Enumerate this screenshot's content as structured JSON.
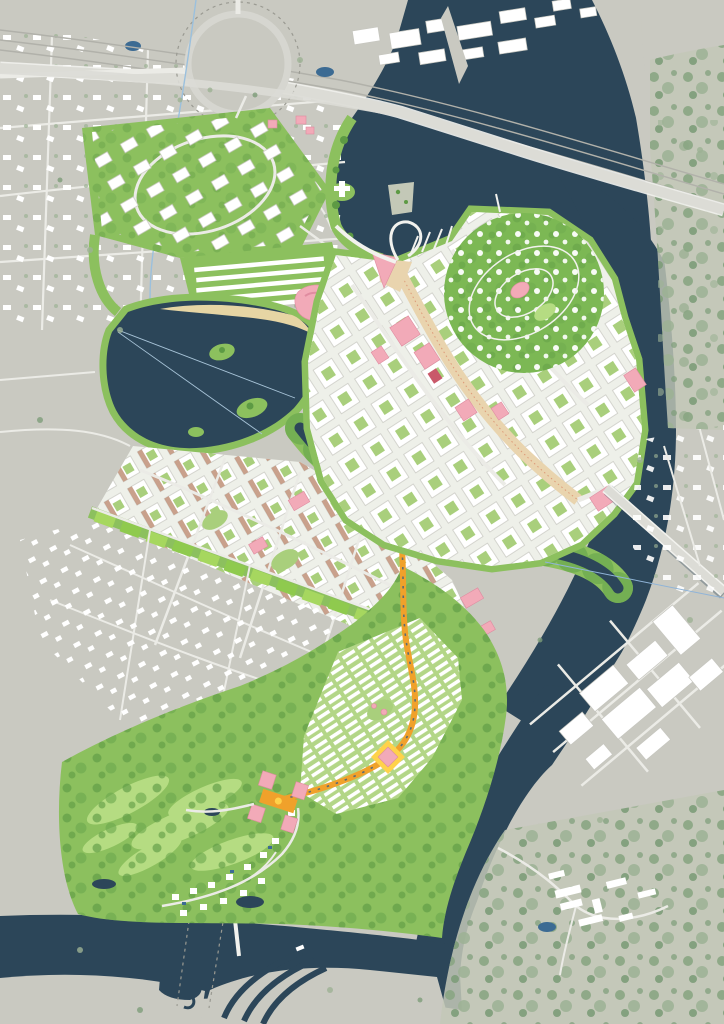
{
  "map": {
    "kind": "illustrated-urban-masterplan-aerial",
    "regions": [
      "existing-suburb-northwest",
      "highway-interchange-roundabout",
      "railway-corridor",
      "river",
      "north-bay",
      "marina",
      "loop-pier",
      "breakwater-spit",
      "city-center-island",
      "main-axis-boulevard",
      "circular-blossom-park",
      "lake-with-islands",
      "lake-beach",
      "lakeside-arena",
      "northwest-office-district",
      "row-housing-strip",
      "west-residential-grid",
      "green-boulevard-belt",
      "existing-settlement-west",
      "mid-channel",
      "south-residential-cluster",
      "orange-transit-spine",
      "plaza-node",
      "campus",
      "golf-course",
      "golf-villas",
      "east-bank-forest",
      "east-industrial-area",
      "east-suburb",
      "east-bridge",
      "highway-bridge",
      "south-river",
      "canal-locks",
      "ferry-crossings",
      "bottom-right-forest-village"
    ]
  },
  "palette": {
    "land": "#c9c9c1",
    "landMuted": "#c3c8b7",
    "road": "#ebebe6",
    "roadMajor": "#dcdcd6",
    "bld": "#ffffff",
    "bldStroke": "#c6c6bf",
    "water": "#2c4659",
    "waterLight": "#3c6b93",
    "park": "#8cc05e",
    "parkLight": "#b5dc82",
    "parkDark": "#5d9a44",
    "cityGround": "#eef0e9",
    "court": "#a9cf7c",
    "sand": "#e9d4ae",
    "beach": "#e6d5a4",
    "orange": "#f0a12b",
    "yellow": "#ffd24a",
    "pink": "#f2aab8",
    "pinkDeep": "#df8ca0",
    "red": "#c9596a",
    "blossom": "#ffffff",
    "rail": "#b1b1aa",
    "stream": "#9bc0dd",
    "belt1": "#a6d75f",
    "belt2": "#8fca4e",
    "tan": "#c09178",
    "tm1": "#8aa583",
    "tm2": "#9db294",
    "tm3": "#7e9d79"
  }
}
